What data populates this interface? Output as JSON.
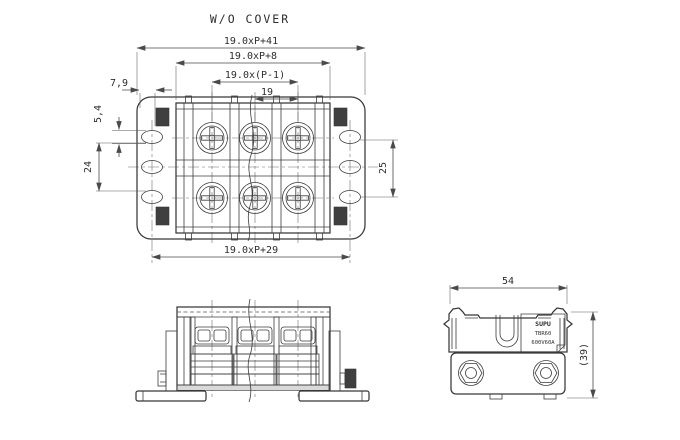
{
  "meta": {
    "title": "W/O COVER"
  },
  "top_view": {
    "dims": {
      "overall": "19.0xP+41",
      "inner_body": "19.0xP+8",
      "pole_span": "19.0x(P-1)",
      "pitch": "19",
      "offset": "7,9",
      "slot": "5,4",
      "left_span": "24",
      "right_span": "25",
      "mounting": "19.0xP+29"
    }
  },
  "side_view": {
    "dims": {
      "width": "54",
      "height": "(39)"
    },
    "marking": {
      "brand": "SUPU",
      "model": "TBR60",
      "rating": "600V60A"
    }
  },
  "colors": {
    "line": "#383838",
    "dimension": "#4a4a4a",
    "background": "#ffffff"
  }
}
